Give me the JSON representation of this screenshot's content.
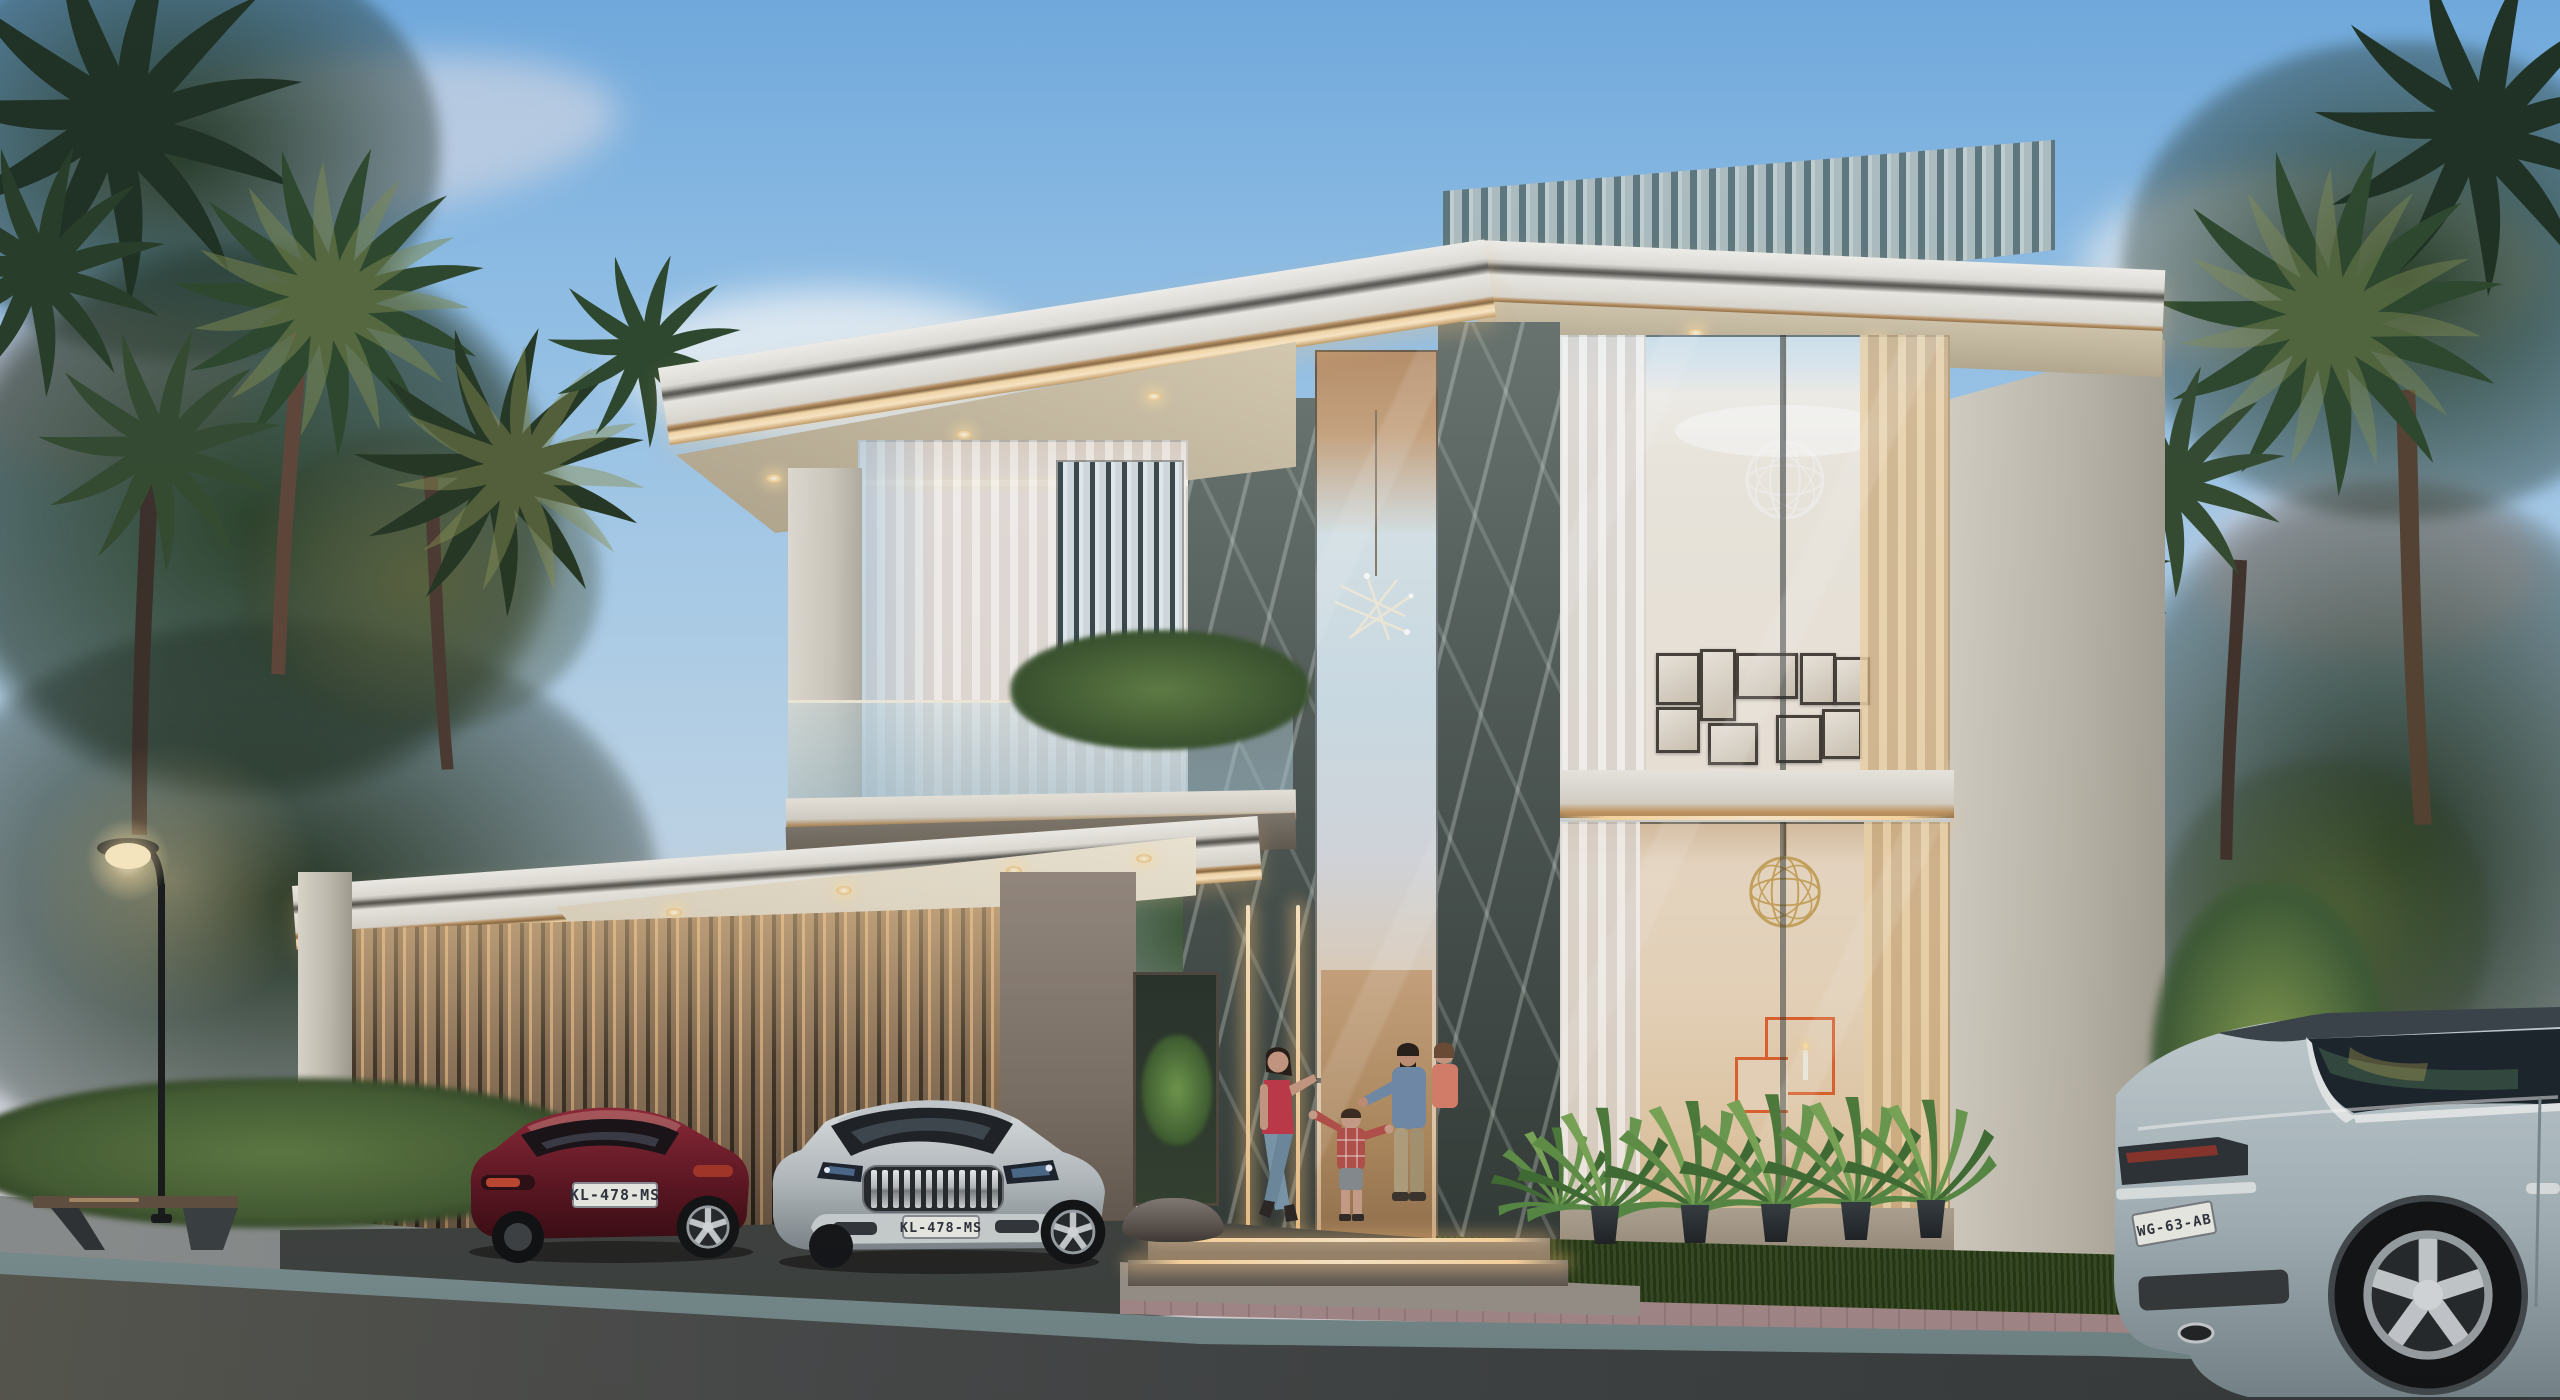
{
  "scene": {
    "type": "architectural-rendering",
    "time_of_day": "dusk",
    "description": "Modern two-storey luxury villa with rooftop louvre screen, book-matched marble piers, floor-to-ceiling glazing, LED-lit carport with two parked cars, a family greeting at the entrance, tropical palm garden, street lamp, bench, and an SUV passing in the foreground"
  },
  "vehicles": {
    "red_hatchback": {
      "body_color": "#6a1622",
      "plate": "KL-478-MS"
    },
    "silver_sedan": {
      "body_color": "#b9c0c3",
      "plate": "KL-478-MS"
    },
    "grey_suv": {
      "body_color": "#b2c1c6",
      "plate": "WG-63-AB"
    }
  },
  "palette": {
    "sky_top": "#6fa9dc",
    "sky_horizon": "#d9cfd2",
    "facade_light": "#ddd8cc",
    "marble_dark": "#4d5752",
    "led_warm": "#f7d9a8",
    "carport_louver_bronze": "#7e6750",
    "roof_screen_slat": "#5d767b",
    "vegetation_dark": "#22351f",
    "vegetation_lit": "#8a9150",
    "interior_warm": "#e6cda9",
    "art_accent_orange": "#e0622c",
    "asphalt": "#3c4142",
    "curb_stone": "#a8bcbe",
    "paver_pink": "#b59a96"
  }
}
